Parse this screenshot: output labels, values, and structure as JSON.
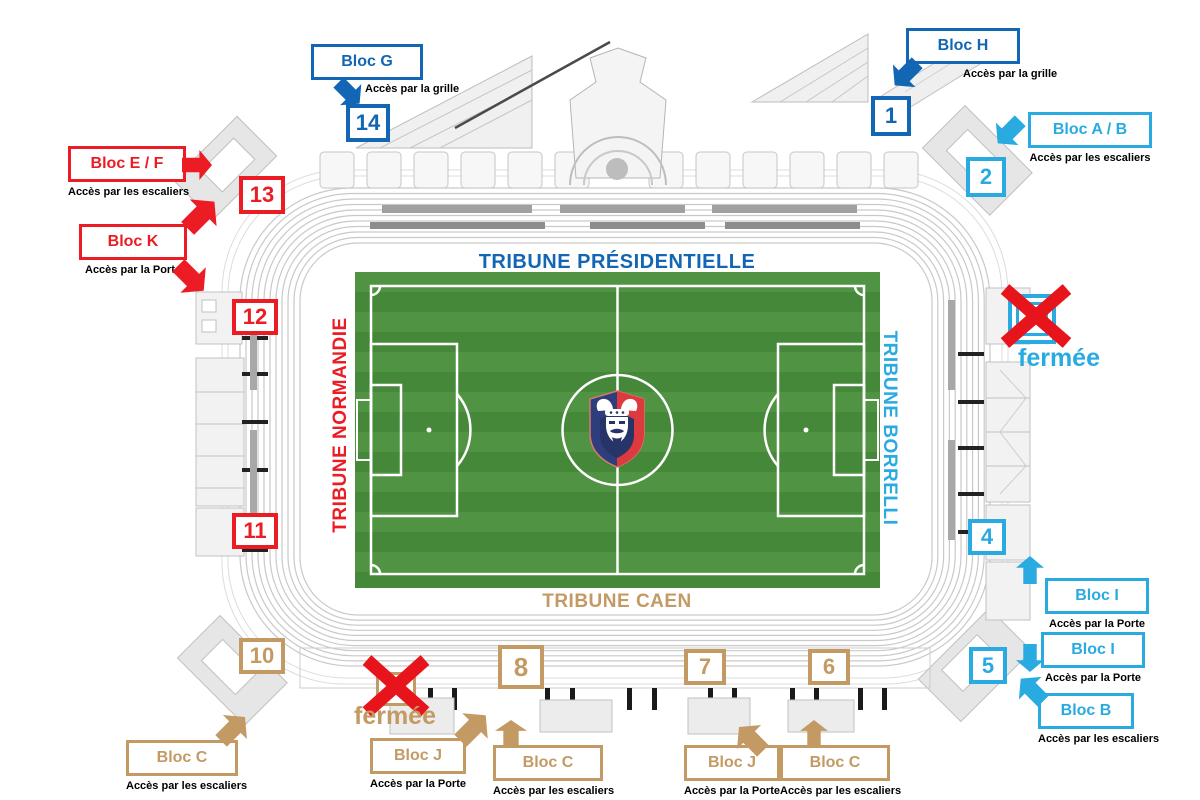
{
  "colors": {
    "dark_blue": "#1266b3",
    "light_blue": "#29abe2",
    "red": "#ec1c24",
    "tan": "#c49a64",
    "field_green": "#4a8c3b"
  },
  "tribunes": {
    "presidentielle": {
      "label": "TRIBUNE PRÉSIDENTIELLE",
      "color": "dark_blue",
      "position": "top"
    },
    "normandie": {
      "label": "TRIBUNE NORMANDIE",
      "color": "red",
      "position": "left"
    },
    "borrelli": {
      "label": "TRIBUNE BORRELLI",
      "color": "light_blue",
      "position": "right"
    },
    "caen": {
      "label": "TRIBUNE CAEN",
      "color": "tan",
      "position": "bottom"
    }
  },
  "gates": [
    {
      "number": "14",
      "color": "dark_blue"
    },
    {
      "number": "13",
      "color": "red"
    },
    {
      "number": "12",
      "color": "red"
    },
    {
      "number": "11",
      "color": "red"
    },
    {
      "number": "10",
      "color": "tan"
    },
    {
      "number": "8",
      "color": "tan"
    },
    {
      "number": "7",
      "color": "tan"
    },
    {
      "number": "6",
      "color": "tan"
    },
    {
      "number": "1",
      "color": "dark_blue"
    },
    {
      "number": "2",
      "color": "light_blue"
    },
    {
      "number": "4",
      "color": "light_blue"
    },
    {
      "number": "5",
      "color": "light_blue"
    }
  ],
  "blocks": [
    {
      "label": "Bloc G",
      "access": "Accès par la grille",
      "color": "dark_blue",
      "arrow": "down-right"
    },
    {
      "label": "Bloc H",
      "access": "Accès par la grille",
      "color": "dark_blue",
      "arrow": "down-left"
    },
    {
      "label": "Bloc A / B",
      "access": "Accès par les escaliers",
      "color": "light_blue",
      "arrow": "down-left"
    },
    {
      "label": "Bloc E / F",
      "access": "Accès par les escaliers",
      "color": "red",
      "arrow": "right"
    },
    {
      "label": "Bloc K",
      "access": "Accès par la Porte",
      "color": "red",
      "arrow": "up-right-and-down-right"
    },
    {
      "label": "Bloc C",
      "access": "Accès par les escaliers",
      "color": "tan",
      "arrow": "up-right"
    },
    {
      "label": "Bloc J",
      "access": "Accès par la Porte",
      "color": "tan",
      "arrow": "up-right"
    },
    {
      "label": "Bloc C",
      "access": "Accès par les escaliers",
      "color": "tan",
      "arrow": "up"
    },
    {
      "label": "Bloc J",
      "access": "Accès par la Porte",
      "color": "tan",
      "arrow": "up-left"
    },
    {
      "label": "Bloc C",
      "access": "Accès par les escaliers",
      "color": "tan",
      "arrow": "up"
    },
    {
      "label": "Bloc I",
      "access": "Accès par la Porte",
      "color": "light_blue",
      "arrow": "up"
    },
    {
      "label": "Bloc I",
      "access": "Accès par la Porte",
      "color": "light_blue",
      "arrow": "down"
    },
    {
      "label": "Bloc B",
      "access": "Accès par les escaliers",
      "color": "light_blue",
      "arrow": "up-left"
    }
  ],
  "closed_gates": [
    {
      "label": "fermée",
      "color": "light_blue",
      "side": "right"
    },
    {
      "label": "fermée",
      "color": "tan",
      "side": "bottom"
    }
  ]
}
